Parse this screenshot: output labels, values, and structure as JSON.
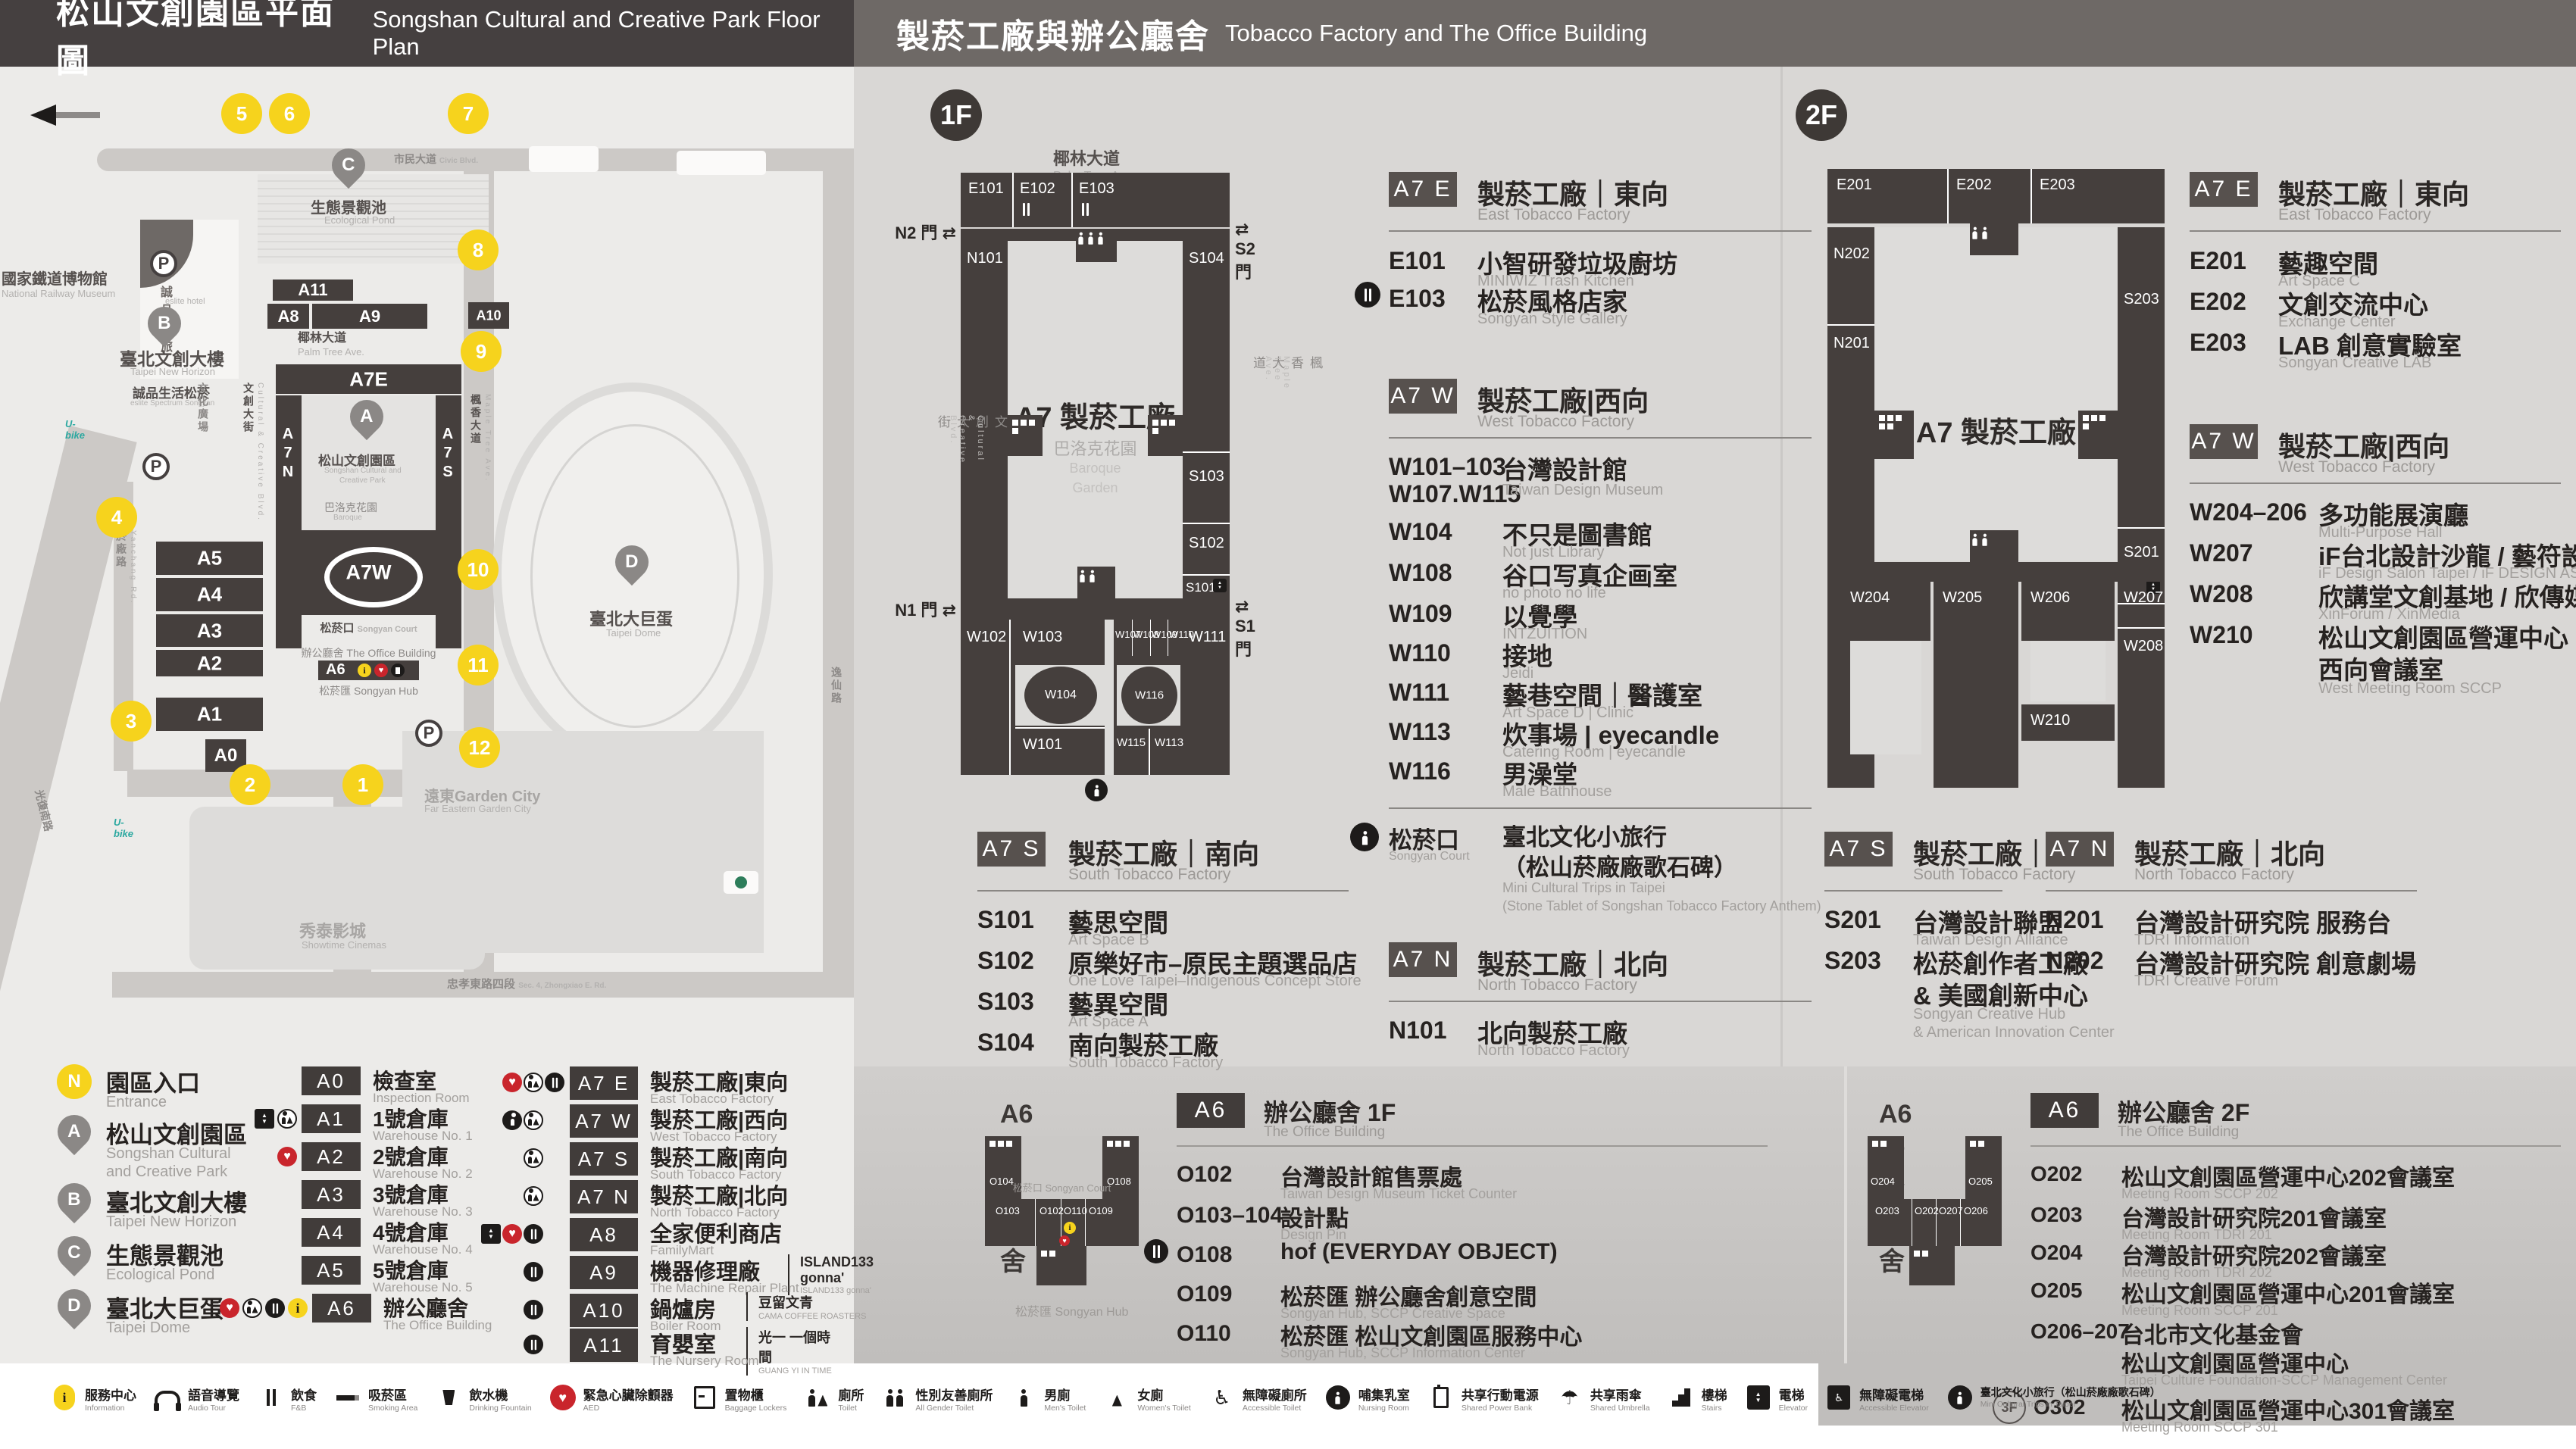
{
  "icons": {
    "gate_arrows": "⇄",
    "north_arrow": "◀",
    "aed_heart": "♥",
    "info_i": "i",
    "umbrella": "☂",
    "access": "♿",
    "elev_up": "▲",
    "elev_down": "▼",
    "parking": "P"
  },
  "header": {
    "left_zh": "松山文創園區平面圖",
    "left_en": "Songshan Cultural and Creative Park Floor Plan",
    "right_zh": "製菸工廠與辦公廳舍",
    "right_en": "Tobacco Factory and The Office Building"
  },
  "map": {
    "museum_zh": "國家鐵道博物館",
    "museum_en": "National Railway Museum",
    "eslite_hotel_zh": "誠品行旅",
    "eslite_hotel_en": "eslite hotel",
    "newhorizon_zh": "臺北文創大樓",
    "newhorizon_en": "Taipei New Horizon",
    "eslite_store_zh": "誠品生活松菸",
    "eslite_store_en": "eslite Spectrum Songyan",
    "pond_zh": "生態景觀池",
    "pond_en": "Ecological Pond",
    "palm_zh": "椰林大道",
    "palm_en": "Palm Tree Ave.",
    "civic_zh": "市民大道",
    "civic_en": "Civic Blvd.",
    "guangfu_zh": "光復南路",
    "guangfu_en": "Guangfu S. Rd.",
    "yanchang_zh": "菸廠路",
    "yanchang_en": "Yanchang Rd.",
    "zhongxiao_zh": "忠孝東路四段",
    "zhongxiao_en": "Sec. 4, Zhongxiao E. Rd.",
    "songyan_ave_zh": "松菸大道",
    "songyan_ave_en": "Songyan Ave.",
    "yixian_zh": "逸仙路",
    "yixian_en": "Yixian Rd.",
    "plaza_zh": "文化廣場",
    "plaza_en": "Cultural Plaza",
    "ccblvd_zh": "文創大街",
    "ccblvd_en": "Cultural & Creative Blvd.",
    "maple_zh": "楓香大道",
    "maple_en": "Maple Tree Ave.",
    "park_zh": "松山文創園區",
    "park_en1": "Songshan Cultural and",
    "park_en2": "Creative Park",
    "baroque_zh": "巴洛克花園",
    "baroque_en1": "Baroque",
    "baroque_en2": "Garden",
    "court_zh": "松菸口",
    "court_en": "Songyan Court",
    "officebldg_zh": "辦公廳舍",
    "officebldg_en": "The Office Building",
    "hub_zh": "松菸匯",
    "hub_en": "Songyan Hub",
    "dome_zh": "臺北大巨蛋",
    "dome_en": "Taipei Dome",
    "cinema_zh": "秀泰影城",
    "cinema_en": "Showtime Cinemas",
    "gardencity_zh": "遠東Garden City",
    "gardencity_en": "Far Eastern Garden City",
    "blocks": {
      "a7e": "A7E",
      "a7w": "A7W",
      "a7n": "A7N",
      "a7s": "A7S",
      "a6": "A6",
      "a0": "A0",
      "a1": "A1",
      "a2": "A2",
      "a3": "A3",
      "a4": "A4",
      "a5": "A5",
      "a8": "A8",
      "a9": "A9",
      "a10": "A10",
      "a11": "A11"
    },
    "entrances": [
      "1",
      "2",
      "3",
      "4",
      "5",
      "6",
      "7",
      "8",
      "9",
      "10",
      "11",
      "12"
    ],
    "pins": {
      "a": "A",
      "b": "B",
      "c": "C",
      "d": "D",
      "n": "N"
    }
  },
  "f1": {
    "floor": "1F",
    "plan": {
      "rooms": {
        "e101": "E101",
        "e102": "E102",
        "e103": "E103",
        "n101": "N101",
        "s104": "S104",
        "s103": "S103",
        "s102": "S102",
        "s101": "S101",
        "w102": "W102",
        "w103": "W103",
        "w104": "W104",
        "w107": "W107",
        "w108": "W108",
        "w109": "W109",
        "w110": "W110",
        "w111": "W111",
        "w101": "W101",
        "w115": "W115",
        "w113": "W113",
        "w116": "W116"
      },
      "gates": {
        "n1": "N1 門",
        "n2": "N2 門",
        "s1": "S1 門",
        "s2": "S2 門"
      },
      "center": "A7 製菸工廠"
    },
    "east": {
      "badge": "A7 E",
      "t_zh": "製菸工廠｜東向",
      "t_en": "East Tobacco Factory",
      "rows": [
        {
          "c": "E101",
          "n": "小智研發垃圾廚坊",
          "s": "MINIWIZ Trash Kitchen"
        },
        {
          "c": "E103",
          "n": "松菸風格店家",
          "s": "Songyan Style Gallery"
        }
      ]
    },
    "west": {
      "badge": "A7 W",
      "t_zh": "製菸工廠|西向",
      "t_en": "West Tobacco Factory",
      "rows": [
        {
          "c": "W101–103",
          "c2": "W107.W115",
          "n": "台灣設計館",
          "s": "Taiwan Design Museum"
        },
        {
          "c": "W104",
          "n": "不只是圖書館",
          "s": "Not just Library"
        },
        {
          "c": "W108",
          "n": "谷口写真企画室",
          "s": "no photo no life"
        },
        {
          "c": "W109",
          "n": "以覺學",
          "s": "INTZUITION"
        },
        {
          "c": "W110",
          "n": "接地",
          "s": "Jeidi"
        },
        {
          "c": "W111",
          "n": "藝巷空間｜醫護室",
          "s": "Art Space D | Clinic"
        },
        {
          "c": "W113",
          "n": "炊事場 | eyecandle",
          "s": "Catering Room | eyecandle"
        },
        {
          "c": "W116",
          "n": "男澡堂",
          "s": "Male Bathhouse"
        }
      ]
    },
    "court": {
      "c": "松菸口",
      "cs": "Songyan Court",
      "n1": "臺北文化小旅行",
      "n2": "（松山菸廠廠歌石碑）",
      "s1": "Mini Cultural Trips in Taipei",
      "s2": "(Stone Tablet of Songshan Tobacco Factory Anthem)"
    },
    "south": {
      "badge": "A7 S",
      "t_zh": "製菸工廠｜南向",
      "t_en": "South Tobacco Factory",
      "rows": [
        {
          "c": "S101",
          "n": "藝思空間",
          "s": "Art Space B"
        },
        {
          "c": "S102",
          "n": "原樂好市–原民主題選品店",
          "s": "One Love Taipei–Indigenous Concept Store"
        },
        {
          "c": "S103",
          "n": "藝異空間",
          "s": "Art Space A"
        },
        {
          "c": "S104",
          "n": "南向製菸工廠",
          "s": "South Tobacco Factory"
        }
      ]
    },
    "north": {
      "badge": "A7 N",
      "t_zh": "製菸工廠｜北向",
      "t_en": "North Tobacco Factory",
      "rows": [
        {
          "c": "N101",
          "n": "北向製菸工廠",
          "s": "North Tobacco Factory"
        }
      ]
    },
    "office": {
      "badge": "A6",
      "t_zh": "辦公廳舍 1F",
      "t_en": "The Office Building",
      "plan_title": "A6 辦公廳舍",
      "plan_rooms": {
        "o104": "O104",
        "o108": "O108",
        "o103": "O103",
        "o102": "O102",
        "o110": "O110",
        "o109": "O109"
      },
      "court": "松菸口",
      "court_en": "Songyan Court",
      "hub": "松菸匯",
      "hub_en": "Songyan Hub",
      "rows": [
        {
          "c": "O102",
          "n": "台灣設計館售票處",
          "s": "Taiwan Design Museum Ticket Counter"
        },
        {
          "c": "O103–104",
          "n": "設計點",
          "s": "Design Pin"
        },
        {
          "c": "O108",
          "n": "hof (EVERYDAY OBJECT)",
          "s": ""
        },
        {
          "c": "O109",
          "n": "松菸匯 辦公廳舍創意空間",
          "s": "Songyan Hub, SCCP Creative Space"
        },
        {
          "c": "O110",
          "n": "松菸匯 松山文創園區服務中心",
          "s": "Songyan Hub, SCCP Information Center"
        }
      ]
    }
  },
  "f2": {
    "floor": "2F",
    "plan": {
      "rooms": {
        "e201": "E201",
        "e202": "E202",
        "e203": "E203",
        "n202": "N202",
        "n201": "N201",
        "s203": "S203",
        "s201": "S201",
        "w204": "W204",
        "w205": "W205",
        "w206": "W206",
        "w207": "W207",
        "w208": "W208",
        "w210": "W210"
      },
      "center": "A7 製菸工廠"
    },
    "east": {
      "badge": "A7 E",
      "t_zh": "製菸工廠｜東向",
      "t_en": "East Tobacco Factory",
      "rows": [
        {
          "c": "E201",
          "n": "藝趣空間",
          "s": "Art Space C"
        },
        {
          "c": "E202",
          "n": "文創交流中心",
          "s": "Exchange Center"
        },
        {
          "c": "E203",
          "n": "LAB 創意實驗室",
          "s": "Songyan Creative LAB"
        }
      ]
    },
    "west": {
      "badge": "A7 W",
      "t_zh": "製菸工廠|西向",
      "t_en": "West Tobacco Factory",
      "rows": [
        {
          "c": "W204–206",
          "n": "多功能展演廳",
          "s": "Multi-Purpose Hall"
        },
        {
          "c": "W207",
          "n": "iF台北設計沙龍 / 藝符設計",
          "s": "iF Design Salon Taipei / iF DESIGN ASIA"
        },
        {
          "c": "W208",
          "n": "欣講堂文創基地 / 欣傳媒",
          "s": "XinForum / XinMedia"
        },
        {
          "c": "W210",
          "n": "松山文創園區營運中心",
          "n2": "西向會議室",
          "s": "West Meeting Room SCCP"
        }
      ]
    },
    "south": {
      "badge": "A7 S",
      "t_zh": "製菸工廠｜南向",
      "t_en": "South Tobacco Factory",
      "rows": [
        {
          "c": "S201",
          "n": "台灣設計聯盟",
          "s": "Taiwan Design Alliance"
        },
        {
          "c": "S203",
          "n": "松菸創作者工廠",
          "n2": "& 美國創新中心",
          "s": "Songyan Creative Hub",
          "s2": "& American Innovation Center"
        }
      ]
    },
    "north": {
      "badge": "A7 N",
      "t_zh": "製菸工廠｜北向",
      "t_en": "North Tobacco Factory",
      "rows": [
        {
          "c": "N201",
          "n": "台灣設計研究院 服務台",
          "s": "TDRI Information"
        },
        {
          "c": "N202",
          "n": "台灣設計研究院 創意劇場",
          "s": "TDRI Creative Forum"
        }
      ]
    },
    "office": {
      "badge": "A6",
      "t_zh": "辦公廳舍 2F",
      "t_en": "The Office Building",
      "plan_title": "A6 辦公廳舍",
      "plan_rooms": {
        "o204": "O204",
        "o205": "O205",
        "o203": "O203",
        "o202": "O202",
        "o207": "O207",
        "o206": "O206"
      },
      "rows": [
        {
          "c": "O202",
          "n": "松山文創園區營運中心202會議室",
          "s": "Meeting Room SCCP 202"
        },
        {
          "c": "O203",
          "n": "台灣設計研究院201會議室",
          "s": "Meeting Room TDRI 201"
        },
        {
          "c": "O204",
          "n": "台灣設計研究院202會議室",
          "s": "Meeting Room TDRI 202"
        },
        {
          "c": "O205",
          "n": "松山文創園區營運中心201會議室",
          "s": "Meeting Room SCCP 201"
        },
        {
          "c": "O206–207",
          "n": "台北市文化基金會",
          "n2": "松山文創園區營運中心",
          "s": "Taipei Culture Foundation-SCCP Management Center"
        },
        {
          "pre": "3F",
          "c": "O302",
          "n": "松山文創園區營運中心301會議室",
          "s": "Meeting Room SCCP 301"
        }
      ]
    }
  },
  "legend": {
    "pins": [
      {
        "k": "N",
        "zh": "園區入口",
        "en": "Entrance"
      },
      {
        "k": "A",
        "zh": "松山文創園區",
        "en": "Songshan Cultural",
        "en2": "and Creative Park"
      },
      {
        "k": "B",
        "zh": "臺北文創大樓",
        "en": "Taipei New Horizon"
      },
      {
        "k": "C",
        "zh": "生態景觀池",
        "en": "Ecological Pond"
      },
      {
        "k": "D",
        "zh": "臺北大巨蛋",
        "en": "Taipei Dome"
      }
    ],
    "bldg": [
      {
        "b": "A0",
        "zh": "檢查室",
        "en": "Inspection Room"
      },
      {
        "b": "A1",
        "zh": "1號倉庫",
        "en": "Warehouse No. 1"
      },
      {
        "b": "A2",
        "zh": "2號倉庫",
        "en": "Warehouse No. 2"
      },
      {
        "b": "A3",
        "zh": "3號倉庫",
        "en": "Warehouse No. 3"
      },
      {
        "b": "A4",
        "zh": "4號倉庫",
        "en": "Warehouse No. 4"
      },
      {
        "b": "A5",
        "zh": "5號倉庫",
        "en": "Warehouse No. 5"
      },
      {
        "b": "A6",
        "zh": "辦公廳舍",
        "en": "The Office Building"
      }
    ],
    "a7": [
      {
        "b": "A7 E",
        "zh": "製菸工廠|東向",
        "en": "East Tobacco Factory"
      },
      {
        "b": "A7 W",
        "zh": "製菸工廠|西向",
        "en": "West Tobacco Factory"
      },
      {
        "b": "A7 S",
        "zh": "製菸工廠|南向",
        "en": "South Tobacco Factory"
      },
      {
        "b": "A7 N",
        "zh": "製菸工廠|北向",
        "en": "North Tobacco Factory"
      },
      {
        "b": "A8",
        "zh": "全家便利商店",
        "en": "FamilyMart"
      },
      {
        "b": "A9",
        "zh": "機器修理廠",
        "ex": "ISLAND133 gonna'",
        "exs": "ISLAND133 gonna'",
        "en": "The Machine Repair Plant"
      },
      {
        "b": "A10",
        "zh": "鍋爐房",
        "ex": "豆留文青",
        "exs": "CAMA COFFEE ROASTERS",
        "en": "Boiler Room"
      },
      {
        "b": "A11",
        "zh": "育嬰室",
        "ex": "光一 一個時間",
        "exs": "GUANG YI IN TIME",
        "en": "The Nursery Room"
      }
    ]
  },
  "iconbar": {
    "items": [
      {
        "zh": "服務中心",
        "en": "Information"
      },
      {
        "zh": "語音導覽",
        "en": "Audio Tour"
      },
      {
        "zh": "飲食",
        "en": "F&B"
      },
      {
        "zh": "吸菸區",
        "en": "Smoking Area"
      },
      {
        "zh": "飲水機",
        "en": "Drinking Fountain"
      },
      {
        "zh": "緊急心臟除顫器",
        "en": "AED"
      },
      {
        "zh": "置物櫃",
        "en": "Baggage Lockers"
      },
      {
        "zh": "廁所",
        "en": "Toilet"
      },
      {
        "zh": "性別友善廁所",
        "en": "All Gender Toilet"
      },
      {
        "zh": "男廁",
        "en": "Men's Toilet"
      },
      {
        "zh": "女廁",
        "en": "Women's Toilet"
      },
      {
        "zh": "無障礙廁所",
        "en": "Accessible Toilet"
      },
      {
        "zh": "哺集乳室",
        "en": "Nursing Room"
      },
      {
        "zh": "共享行動電源",
        "en": "Shared Power Bank"
      },
      {
        "zh": "共享雨傘",
        "en": "Shared Umbrella"
      },
      {
        "zh": "樓梯",
        "en": "Stairs"
      },
      {
        "zh": "電梯",
        "en": "Elevator"
      },
      {
        "zh": "無障礙電梯",
        "en": "Accessible Elevator"
      },
      {
        "zh": "臺北文化小旅行（松山菸廠廠歌石碑）",
        "en": "Mini Cultural Trips in Taipei"
      }
    ]
  }
}
